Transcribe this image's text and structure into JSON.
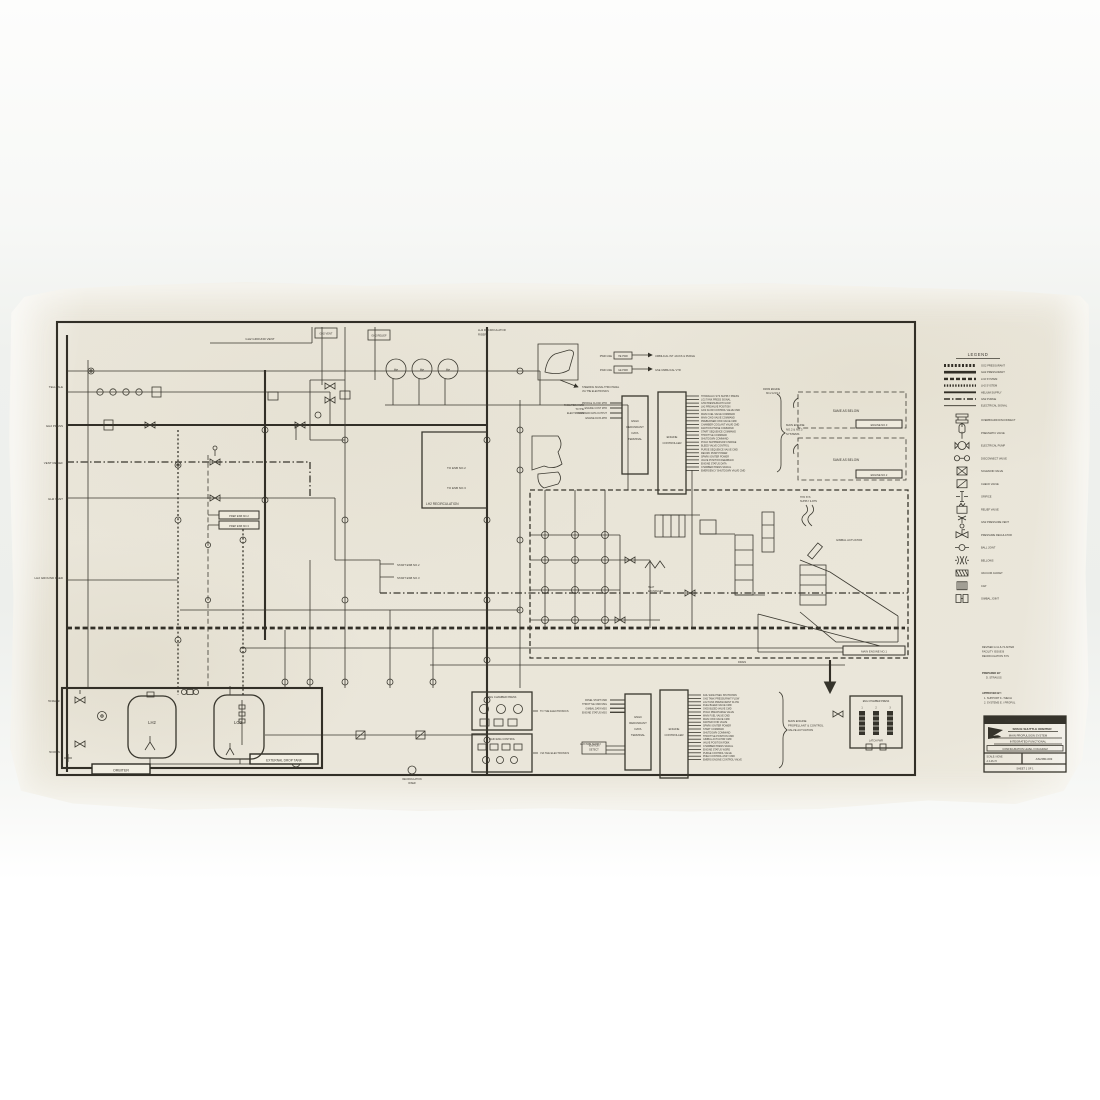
{
  "photo": {
    "paper_color": "#e9e5d8",
    "ink_color": "#35332b",
    "background": "#f2f3f1"
  },
  "drawing": {
    "left_labels": {
      "telltale": "TELLTALE",
      "gh2_press": "GH2 PRESS",
      "vent_relief": "VENT RELIEF",
      "gh2_vent": "GH2 VENT",
      "ground_feed": "LH2 GROUND FEED"
    },
    "top_labels": {
      "ground_vent": "GH2 GROUND VENT",
      "vent_box": "GH2 VENT",
      "relief_box": "GH2 RELIEF",
      "riser1": "LH2 RECIRCULATOR",
      "riser2": "RISER"
    },
    "gauges": [
      "He",
      "He",
      "He"
    ],
    "prep_boxes": [
      "PREP ESB NO.2",
      "PREP ESB NO.3"
    ],
    "start_labels": [
      "START ESB NO.2",
      "START ESB NO.3"
    ],
    "recirc_box": {
      "l1": "TO ESB NO.2",
      "l2": "TO ESB NO.3",
      "caption": "LH2 RECIRCULATION"
    },
    "same_as_below": {
      "text": "SAME AS BELOW",
      "tag3": "ENGINE NO.3",
      "tag2": "ENGINE NO.2",
      "from1": "FROM ENGINE",
      "from2": "NO.2 & NO.3"
    },
    "main_engine_tag": "MAIN ENGINE NO.1",
    "gimbal_label": "GIMBAL ACTUATOR",
    "hyd1": "HYD SYS",
    "hyd2": "SUPPLY & RTN",
    "heat1": "HEAT",
    "heat2": "EXCHANGER",
    "drain": "DRAIN",
    "external_tank": {
      "caption": "EXTERNAL DROP TANK",
      "lh2": "LH2",
      "lo2": "LO2",
      "relief": "H2 RELIEF",
      "drain": "H2 DRAIN"
    },
    "orbiter_tag": "ORBITER",
    "riser_note1": "RECIRCULATION",
    "riser_note2": "RISER",
    "umbilical": {
      "pwr_gse": "PWR GSE",
      "fwd_gse": "FWD GSE",
      "he_pwr": "HE PWR",
      "ge_pwr": "GE PWR",
      "umb1": "UMBILICAL INT JACKS & PURGE",
      "umb2": "GSE UMBILICAL VTR",
      "note1": "STEERING SIGNAL THRU PANEL",
      "note2": "VIA THE ELECTRONICS"
    },
    "facilities_note": [
      "FACILITIES HARD",
      "TO THE",
      "ELECTRONICS"
    ],
    "upper_inputs": [
      "PROFILE CLOCK MTR",
      "ENGINE CONT MTR",
      "COMMAND DATA OUTPUT",
      "ENGINE DATA MTR"
    ],
    "gnc_box": [
      "GN&C",
      "REDUNDANT",
      "DATA",
      "TERMINAL"
    ],
    "controller_box": [
      "ENGINE",
      "CONTROLLER"
    ],
    "upper_signals": [
      "HYDRAULIC SYS SUPPLY PRESS",
      "LO2 TANK PRESS SIGNAL",
      "GH2 PRESSURANT FLOW",
      "LH2 PREVALVE POSITION",
      "GO2 FLOW CONTROL VALVE CMD",
      "MAIN FUEL VALVE COMMAND",
      "MAIN OXID VALVE COMMAND",
      "PREBURNER OXID VALVE CMD",
      "CHAMBER COOLANT VALVE CMD",
      "IGNITION PHASE COMMAND",
      "START SEQUENCE COMMAND",
      "THROTTLE COMMAND",
      "SHUTDOWN COMMAND",
      "POGO SUPPRESSOR CHARGE",
      "BLEED VALVE CONTROL",
      "PURGE SEQUENCE VALVE CMD",
      "RECIRC PUMP POWER",
      "SPARK IGNITER POWER",
      "VALVE POSITION FEEDBACK",
      "ENGINE STATUS DATA",
      "CHAMBER PRESS SIGNAL",
      "EMERGENCY SHUTDOWN VALVE CMD"
    ],
    "upper_brace_label": [
      "MAIN ENGINE",
      "NO.2 & NO.3",
      "SYSTEMS"
    ],
    "lower_inputs": [
      "PANEL START CMD",
      "THROTTLE CMD MSG",
      "GIMBAL DATA MSG",
      "ENGINE STATUS MSG"
    ],
    "aux_pwr": "AUX PWR SUPPLY",
    "lower_signals": [
      "FAIL SAFE PNEU SHUTDOWN",
      "GH2 TANK PRESSURANT FLOW",
      "LO2 TANK PRESSURANT FLOW",
      "FUEL BLEED VALVE CMD",
      "OXID BLEED VALVE CMD",
      "POGO PRECHARGE VALVE",
      "MAIN FUEL VALVE CMD",
      "MAIN OXID VALVE CMD",
      "IGNITER OXID VALVE",
      "SPARK IGNITER POWER",
      "START COMMAND",
      "SHUTDOWN COMMAND",
      "THROTTLE POSITION CMD",
      "GIMBAL ACTUATOR CMD",
      "VALVE POSITION FDBK",
      "CHAMBER PRESS SIGNAL",
      "ENGINE STATUS WORD",
      "PURGE CONTROL VALVE",
      "PNEU CONTROL ASSY CMD",
      "EMERG ENGINE CONTROL VALVE"
    ],
    "lower_brace_label": [
      "MAIN ENGINE",
      "PROPELLANT & CONTROL",
      "VALVE ACTUATION"
    ],
    "panel1_title": "ENG CHAMBER PRESS",
    "panel2_title": "MAIN ENG CONTROL",
    "to_electronics": "TO THE ELECTRONICS",
    "via_electronics": "VIA THE ELECTRONICS",
    "ignition_box": [
      "IGNITION",
      "DETECT"
    ],
    "cab_panel": {
      "title": "ENG CHAMBER PRESS",
      "cols": [
        "1",
        "2",
        "3"
      ],
      "sub": "LATCH  PWR"
    }
  },
  "legend": {
    "title": "LEGEND",
    "line_items": [
      {
        "style": "hatch",
        "label": "GO2 PRESSURANT"
      },
      {
        "style": "solid",
        "label": "GH2 PRESSURANT"
      },
      {
        "style": "dash",
        "label": "LO2 SYSTEM"
      },
      {
        "style": "hatch2",
        "label": "LH2 SYSTEM"
      },
      {
        "style": "solid2",
        "label": "HELIUM SUPPLY"
      },
      {
        "style": "dashdot",
        "label": "GN2 PURGE"
      },
      {
        "style": "thin",
        "label": "ELECTRICAL SIGNAL"
      }
    ],
    "symbol_items": [
      {
        "icon": "overboard-disconnect",
        "label": "OVERBOARD DISCONNECT"
      },
      {
        "icon": "pneumatic-valve",
        "label": "PNEUMATIC VALVE"
      },
      {
        "icon": "electrical-pump",
        "label": "ELECTRICAL PUMP"
      },
      {
        "icon": "disconnect-valve",
        "label": "DISCONNECT VALVE"
      },
      {
        "icon": "solenoid-valve",
        "label": "SOLENOID VALVE"
      },
      {
        "icon": "check-valve",
        "label": "CHECK VALVE"
      },
      {
        "icon": "orifice",
        "label": "ORIFICE"
      },
      {
        "icon": "relief-valve",
        "label": "RELIEF VALVE"
      },
      {
        "icon": "pressure-vent",
        "label": "GN2 PRESSURE VENT"
      },
      {
        "icon": "regulator",
        "label": "PRESSURE REGULATOR"
      },
      {
        "icon": "ball-joint",
        "label": "BALL JOINT"
      },
      {
        "icon": "bellows",
        "label": "BELLOWS"
      },
      {
        "icon": "vacuum-jacket",
        "label": "VACUUM JACKET"
      },
      {
        "icon": "cap",
        "label": "CAP"
      },
      {
        "icon": "gimbal-joint",
        "label": "GIMBAL JOINT"
      }
    ]
  },
  "notes": {
    "revision": [
      "REVISED A  11-6-72  AFTER",
      "FACILITY ISSUE B",
      "RECIRCULATION SYS"
    ],
    "prepared": [
      "PREPARED BY",
      "D. STRAUSS"
    ],
    "approved": [
      "APPROVED BY:",
      "1. SUPPORT   F. / MECH",
      "2. SYSTEMS   E. / PROPUL"
    ]
  },
  "title_block": {
    "company": "GRUMMAN AEROSPACE",
    "product": "SPACE SHUTTLE ORBITER",
    "line1": "MAIN PROPULSION SYSTEM",
    "line2": "INTEGRATED FUNCTIONAL",
    "line3": "CONFIGURATION LEVEL II DIAGRAM",
    "scale": "SCALE: NONE",
    "date": "A  4-26-72",
    "dwg_no": "ASL580-003",
    "sheet": "SHEET 1 OF 1"
  }
}
